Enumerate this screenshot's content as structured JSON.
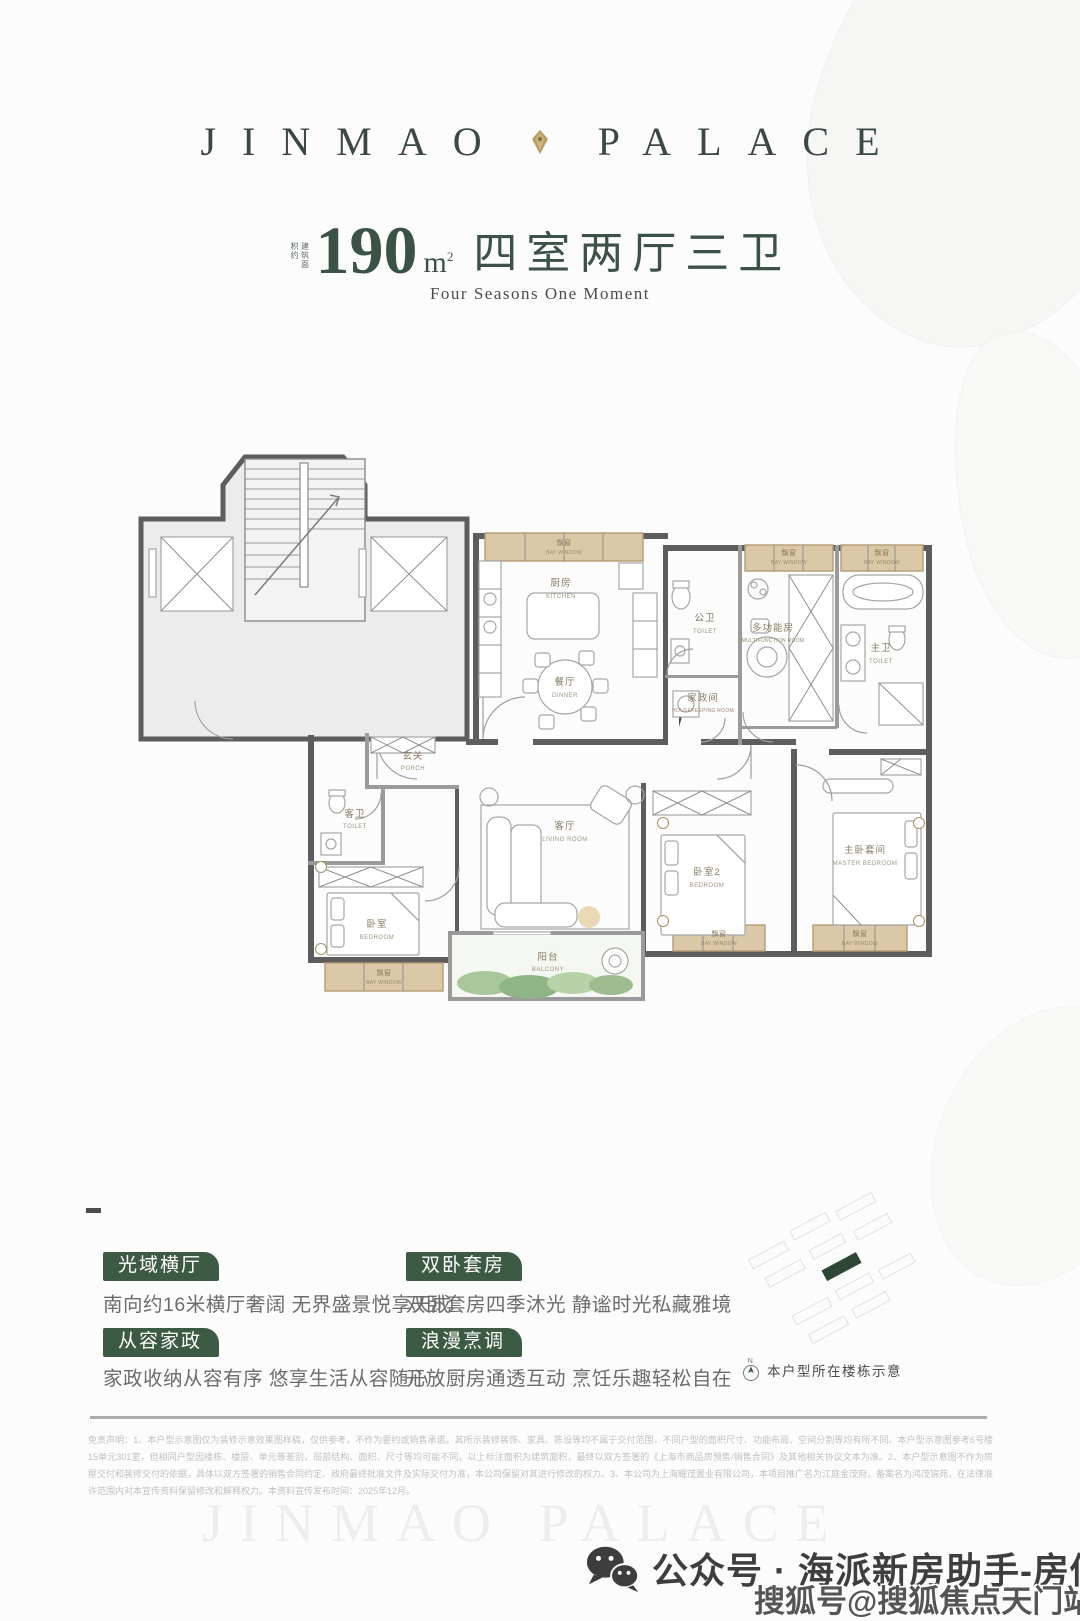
{
  "header": {
    "brand_left": "JINMAO",
    "brand_right": "PALACE"
  },
  "title": {
    "prefix": "建筑面积约",
    "number": "190",
    "unit": "m",
    "sup": "2",
    "layout": "四室两厅三卫",
    "subtitle": "Four Seasons One Moment"
  },
  "floorplan": {
    "labels": {
      "bay_window": {
        "zh": "飘窗",
        "en": "BAY WINDOW"
      },
      "kitchen": {
        "zh": "厨房",
        "en": "KITCHEN"
      },
      "dinner": {
        "zh": "餐厅",
        "en": "DINNER"
      },
      "public_toilet": {
        "zh": "公卫",
        "en": "TOILET"
      },
      "housekeeping": {
        "zh": "家政间",
        "en": "HOUSEKEEPING ROOM"
      },
      "multifunction": {
        "zh": "多功能房",
        "en": "MULTIFUNCTION ROOM"
      },
      "master_toilet": {
        "zh": "主卫",
        "en": "TOILET"
      },
      "porch": {
        "zh": "玄关",
        "en": "PORCH"
      },
      "guest_toilet": {
        "zh": "客卫",
        "en": "TOILET"
      },
      "bedroom": {
        "zh": "卧室",
        "en": "BEDROOM"
      },
      "living_room": {
        "zh": "客厅",
        "en": "LIVING ROOM"
      },
      "balcony": {
        "zh": "阳台",
        "en": "BALCONY"
      },
      "bedroom2": {
        "zh": "卧室2",
        "en": "BEDROOM"
      },
      "master_bedroom": {
        "zh": "主卧套间",
        "en": "MASTER BEDROOM"
      }
    }
  },
  "features": {
    "items": [
      {
        "badge": "光域横厅",
        "text": "南向约16米横厅奢阔 无界盛景悦享天成"
      },
      {
        "badge": "双卧套房",
        "text": "双卧套房四季沐光 静谧时光私藏雅境"
      },
      {
        "badge": "从容家政",
        "text": "家政收纳从容有序 悠享生活从容随心"
      },
      {
        "badge": "浪漫烹调",
        "text": "开放厨房通透互动 烹饪乐趣轻松自在"
      }
    ]
  },
  "sitemap": {
    "compass": "N",
    "caption": "本户型所在楼栋示意"
  },
  "disclaimer": {
    "text": "免责声明：1、本户型示意图仅为装修示意效果图样稿，仅供参考，不作为要约或销售承诺。其所示装修装饰、家具、陈设等均不属于交付范围，不同户型的面积尺寸、功能布局、空间分割等均有所不同。本户型示意图参考6号楼15单元301室，但相同户型因楼栋、楼层、单元等差别，局部结构、面积、尺寸等均可能不同。以上标注面积为建筑面积，最终以双方签署的《上海市商品房预售/销售合同》及其他相关协议文本为准。2、本户型示意图不作为房屋交付和装修交付的依据，具体以双方签署的销售合同约定、政府最终批准文件及实际交付为准，本公司保留对其进行修改的权力。3、本公司为上海耀茂置业有限公司，本项目推广名为江庭金茂府，备案名为鸿茂锦苑，在法律准许范围内对本宣传资料保留修改和解释权力。本资料宣传发布时间：2025年12月。"
  },
  "footer": {
    "watermark": "JINMAO PALACE",
    "wechat_label": "公众号 · 海派新房助手-房似锦",
    "sohu_label": "搜狐号@搜狐焦点天门站"
  },
  "colors": {
    "accent_green": "#3d5a45",
    "title_green": "#3b5246",
    "bay_tan": "#dbc8a9",
    "wall_gray": "#5d5d5d",
    "balcony_green": "#a9c79b"
  }
}
